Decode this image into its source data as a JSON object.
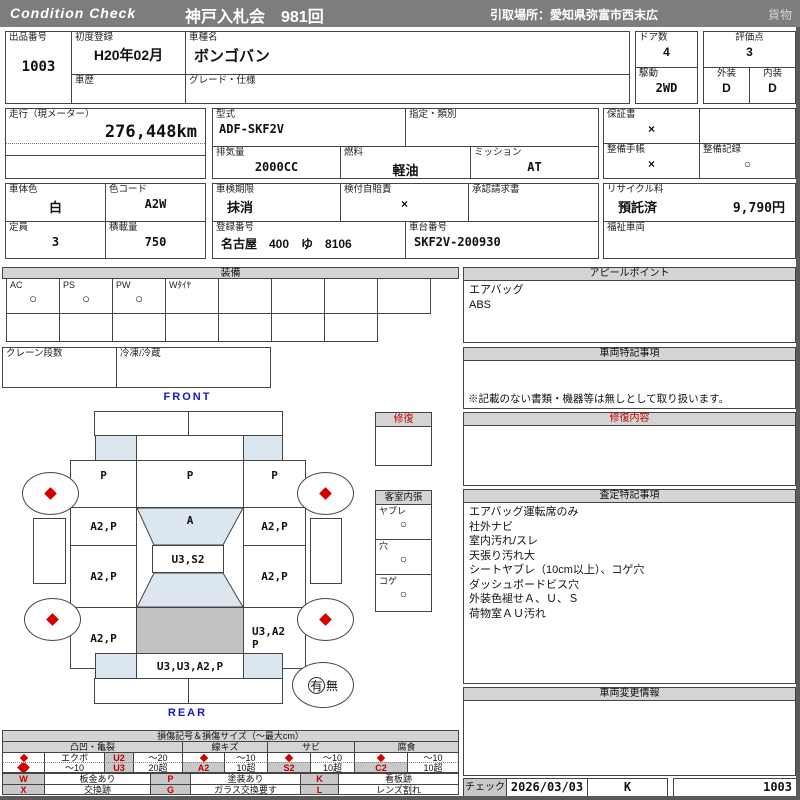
{
  "header": {
    "brand": "Condition  Check",
    "title": "神戸入札会　981回",
    "pickup": "引取場所：愛知県弥富市西末広",
    "category": "貨物"
  },
  "lot": {
    "label": "出品番号",
    "value": "1003"
  },
  "first_reg": {
    "label": "初度登録",
    "value": "H20年02月"
  },
  "history": {
    "label": "車歴",
    "value": ""
  },
  "model": {
    "label": "車種名",
    "value": "ボンゴバン"
  },
  "grade": {
    "label": "グレード・仕様",
    "value": ""
  },
  "doors": {
    "label": "ドア数",
    "value": "4"
  },
  "drive": {
    "label": "駆動",
    "value": "2WD"
  },
  "score": {
    "label": "評価点",
    "value": "3"
  },
  "exterior": {
    "label": "外装",
    "value": "D"
  },
  "interior": {
    "label": "内装",
    "value": "D"
  },
  "mileage": {
    "label": "走行（現メーター）",
    "value": "276,448km"
  },
  "model_code": {
    "label": "型式",
    "value": "ADF-SKF2V"
  },
  "class_type": {
    "label": "指定・類別",
    "value": ""
  },
  "displacement": {
    "label": "排気量",
    "value": "2000CC"
  },
  "fuel": {
    "label": "燃料",
    "value": "軽油"
  },
  "mission": {
    "label": "ミッション",
    "value": "AT"
  },
  "warranty": {
    "label": "保証書",
    "value": "×"
  },
  "maint_book": {
    "label": "整備手帳",
    "value": "×"
  },
  "maint_record": {
    "label": "整備記録",
    "value": "○"
  },
  "body_color": {
    "label": "車体色",
    "value": "白"
  },
  "color_code": {
    "label": "色コード",
    "value": "A2W"
  },
  "capacity": {
    "label": "定員",
    "value": "3"
  },
  "payload": {
    "label": "積載量",
    "value": "750"
  },
  "inspection": {
    "label": "車検期限",
    "value": "抹消"
  },
  "insurance": {
    "label": "検付自賠責",
    "value": "×"
  },
  "approval": {
    "label": "承認請求書",
    "value": ""
  },
  "reg_no": {
    "label": "登録番号",
    "value": "名古屋　400　ゆ　8106"
  },
  "chassis": {
    "label": "車台番号",
    "value": "SKF2V-200930"
  },
  "recycle": {
    "label": "リサイクル料",
    "status": "預託済",
    "fee": "9,790円"
  },
  "welfare": {
    "label": "福祉車両",
    "value": ""
  },
  "equipment": {
    "title": "装備",
    "items": [
      {
        "label": "AC",
        "value": "○"
      },
      {
        "label": "PS",
        "value": "○"
      },
      {
        "label": "PW",
        "value": "○"
      },
      {
        "label": "Wﾀｲﾔ",
        "value": ""
      },
      {
        "label": "",
        "value": ""
      },
      {
        "label": "",
        "value": ""
      },
      {
        "label": "",
        "value": ""
      },
      {
        "label": "",
        "value": ""
      }
    ],
    "crane": {
      "label": "クレーン段数",
      "value": ""
    },
    "reefer": {
      "label": "冷凍/冷蔵",
      "value": ""
    }
  },
  "appeal": {
    "title": "アピールポイント",
    "lines": [
      "エアバッグ",
      "ABS"
    ]
  },
  "special_notes": {
    "title": "車両特記事項",
    "footnote": "※記載のない書類・機器等は無しとして取り扱います。"
  },
  "repair_content": {
    "title": "修復内容"
  },
  "assessment": {
    "title": "査定特記事項",
    "lines": [
      "エアバッグ運転席のみ",
      "社外ナビ",
      "室内汚れ/スレ",
      "天張り汚れ大",
      "シートヤブレ（10cm以上）、コゲ穴",
      "ダッシュボードビス穴",
      "外装色褪せＡ、Ｕ、Ｓ",
      "荷物室ＡＵ汚れ"
    ]
  },
  "change_info": {
    "title": "車両変更情報"
  },
  "check": {
    "label": "チェック",
    "date": "2026/03/03",
    "inspector": "K",
    "lot": "1003"
  },
  "diagram": {
    "front": "FRONT",
    "rear": "REAR",
    "repair": {
      "title": "修復"
    },
    "cabin": {
      "title": "客室内張",
      "items": [
        {
          "label": "ヤブレ",
          "value": "○"
        },
        {
          "label": "穴",
          "value": "○"
        },
        {
          "label": "コゲ",
          "value": "○"
        }
      ]
    },
    "presence": {
      "yes": "有",
      "no": "無"
    },
    "panels": {
      "hood_l": "P",
      "hood_c": "P",
      "hood_r": "P",
      "windshield": "A",
      "roof": "U3,S2",
      "l1": "A2,P",
      "l2": "A2,P",
      "l3": "A2,P",
      "r1": "A2,P",
      "r2": "A2,P",
      "r3a": "U3,A2",
      "r3b": "P",
      "rear_panel": "U3,U3,A2,P"
    }
  },
  "legend": {
    "title": "損傷記号＆損傷サイズ（～最大cm）",
    "g1": "凸凹・亀裂",
    "g2": "線キズ",
    "g3": "サビ",
    "g4": "腐食",
    "dent": {
      "r1_label": "エクボ",
      "r1_code": "U2",
      "r1_size": "～20",
      "r2_label": "～10",
      "r2_code": "U3",
      "r2_size": "20超"
    },
    "scratch": {
      "code": "A2",
      "s1": "～10",
      "s2": "10超"
    },
    "rust": {
      "code": "S2",
      "s1": "～10",
      "s2": "10超"
    },
    "corrosion": {
      "code": "C2",
      "s1": "～10",
      "s2": "10超"
    },
    "codes": {
      "w": "W",
      "w_desc": "板金あり",
      "x": "X",
      "x_desc": "交換跡",
      "p": "P",
      "p_desc": "塗装あり",
      "g": "G",
      "g_desc": "ガラス交換要す",
      "k": "K",
      "k_desc": "看板跡",
      "l": "L",
      "l_desc": "レンズ割れ"
    }
  }
}
